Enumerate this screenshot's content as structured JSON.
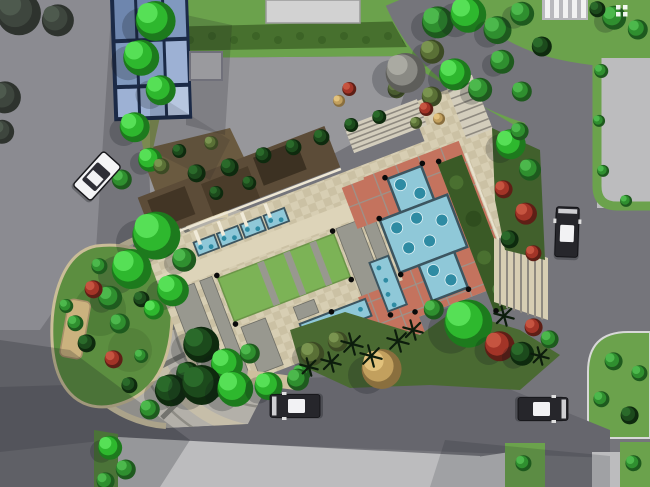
{
  "meta": {
    "width": 650,
    "height": 487,
    "view": "site-plan-top-down"
  },
  "palette": {
    "road": "#75757b",
    "roadLight": "#8b8b91",
    "roadBottom": "#66666d",
    "sidewalk": "#bcbcbe",
    "padTop": "#d2d2d2",
    "forecourt": "#97979b",
    "lawn": "#6ba24c",
    "lawnBright": "#7cb356",
    "lawnDark": "#55803a",
    "hedgeRow": "#47702e",
    "median": "#7b8a50",
    "plazaBeigeA": "#d7ceb3",
    "plazaBeigeB": "#cbc1a4",
    "walkBeige": "#ddd4b9",
    "walkGray": "#98988f",
    "walkGrayEdge": "#6e6e66",
    "redPaving": "#c4735e",
    "redLine": "#9b938b",
    "poolBlue": "#8fc8d8",
    "poolDeep": "#2e8ba3",
    "poolEdge": "#3c5560",
    "hedgeGreen": "#3a5a26",
    "terraceBrown": "#5c4c38",
    "terraceDark": "#423525",
    "gardenBed": "#6a5a40",
    "glassDark": "#6e86ae",
    "glassMid": "#8099bf",
    "glassLight": "#9db1d4",
    "glassFrame": "#1b2a47",
    "fanPaving": "#b3b0a9",
    "fanSpoke": "#73736e",
    "fanArc": "#8e8c85",
    "rimBeige": "#d6cbaa",
    "island": "#5c8e40",
    "islandEdge": "#cabd98",
    "benchTan": "#cbb27e",
    "plantBedSE": "#4a6a32",
    "plantBandE": "#41602c",
    "stepLight": "#d3cdbc",
    "stepLine": "#8f8a80",
    "carDark": "#26262b",
    "carLight": "#f4f4f6",
    "carGlass": "#2e2e36",
    "carRoof": "#f2f2f4",
    "crosswalkPad": "#b9b9bd",
    "crosswalkBar": "#f2f2f2",
    "shadow": "#14161c",
    "white": "#ffffff",
    "black": "#0a0a0a"
  },
  "tree_palettes": {
    "bright": [
      "#1d7a1d",
      "#2eb82e",
      "#56e056"
    ],
    "mid": [
      "#1e5a1e",
      "#2f8f2f",
      "#4cb84c"
    ],
    "dark": [
      "#0e2a0e",
      "#1c4a1c",
      "#2a6a2a"
    ],
    "olive": [
      "#3c4a24",
      "#5a7036",
      "#7a9450"
    ],
    "red": [
      "#5e1f16",
      "#a23427",
      "#c65440"
    ],
    "gray": [
      "#5e5e5a",
      "#8a8a84",
      "#aaaaa2"
    ],
    "tan": [
      "#8a6f3e",
      "#c2a05e",
      "#e2c27c"
    ],
    "sil": [
      "#2e332e",
      "#3e463e",
      "#4e5a4e"
    ]
  },
  "trees": [
    [
      152,
      18,
      20,
      "bright"
    ],
    [
      138,
      55,
      18,
      "bright"
    ],
    [
      158,
      88,
      15,
      "bright"
    ],
    [
      132,
      125,
      15,
      "bright"
    ],
    [
      148,
      158,
      12,
      "bright"
    ],
    [
      120,
      178,
      10,
      "mid"
    ],
    [
      15,
      10,
      22,
      "sil"
    ],
    [
      55,
      18,
      16,
      "sil"
    ],
    [
      2,
      95,
      16,
      "sil"
    ],
    [
      0,
      130,
      12,
      "sil"
    ],
    [
      435,
      20,
      16,
      "mid"
    ],
    [
      465,
      12,
      18,
      "bright"
    ],
    [
      495,
      28,
      14,
      "mid"
    ],
    [
      520,
      12,
      12,
      "mid"
    ],
    [
      540,
      45,
      10,
      "dark"
    ],
    [
      430,
      50,
      12,
      "olive"
    ],
    [
      452,
      72,
      16,
      "bright"
    ],
    [
      478,
      88,
      12,
      "mid"
    ],
    [
      430,
      95,
      10,
      "olive"
    ],
    [
      500,
      60,
      12,
      "mid"
    ],
    [
      520,
      90,
      10,
      "mid"
    ],
    [
      395,
      88,
      9,
      "olive"
    ],
    [
      402,
      70,
      20,
      "gray"
    ],
    [
      425,
      108,
      7,
      "red"
    ],
    [
      438,
      118,
      6,
      "tan"
    ],
    [
      415,
      122,
      6,
      "olive"
    ],
    [
      348,
      88,
      7,
      "red"
    ],
    [
      338,
      100,
      6,
      "tan"
    ],
    [
      612,
      16,
      12,
      "mid"
    ],
    [
      636,
      28,
      10,
      "mid"
    ],
    [
      596,
      8,
      8,
      "dark"
    ],
    [
      152,
      232,
      24,
      "bright"
    ],
    [
      128,
      266,
      20,
      "bright"
    ],
    [
      170,
      288,
      16,
      "bright"
    ],
    [
      108,
      296,
      12,
      "mid"
    ],
    [
      182,
      258,
      12,
      "mid"
    ],
    [
      195,
      172,
      9,
      "dark"
    ],
    [
      228,
      166,
      9,
      "dark"
    ],
    [
      262,
      154,
      8,
      "dark"
    ],
    [
      292,
      146,
      8,
      "dark"
    ],
    [
      215,
      192,
      7,
      "dark"
    ],
    [
      248,
      182,
      7,
      "dark"
    ],
    [
      320,
      136,
      8,
      "dark"
    ],
    [
      350,
      124,
      7,
      "dark"
    ],
    [
      378,
      116,
      7,
      "dark"
    ],
    [
      160,
      165,
      8,
      "olive"
    ],
    [
      178,
      150,
      7,
      "dark"
    ],
    [
      210,
      142,
      7,
      "olive"
    ],
    [
      198,
      342,
      18,
      "dark"
    ],
    [
      224,
      362,
      16,
      "bright"
    ],
    [
      186,
      372,
      12,
      "dark"
    ],
    [
      248,
      352,
      10,
      "mid"
    ],
    [
      210,
      385,
      12,
      "bright"
    ],
    [
      92,
      288,
      9,
      "red"
    ],
    [
      118,
      322,
      10,
      "mid"
    ],
    [
      85,
      342,
      9,
      "dark"
    ],
    [
      112,
      358,
      9,
      "red"
    ],
    [
      140,
      298,
      8,
      "dark"
    ],
    [
      74,
      322,
      8,
      "mid"
    ],
    [
      128,
      384,
      8,
      "dark"
    ],
    [
      152,
      308,
      10,
      "bright"
    ],
    [
      98,
      265,
      8,
      "mid"
    ],
    [
      65,
      305,
      7,
      "mid"
    ],
    [
      140,
      355,
      7,
      "mid"
    ],
    [
      508,
      142,
      15,
      "bright"
    ],
    [
      528,
      168,
      11,
      "mid"
    ],
    [
      502,
      188,
      9,
      "red"
    ],
    [
      524,
      212,
      11,
      "red"
    ],
    [
      508,
      238,
      9,
      "dark"
    ],
    [
      532,
      252,
      8,
      "red"
    ],
    [
      518,
      130,
      9,
      "mid"
    ],
    [
      378,
      366,
      20,
      "tan"
    ],
    [
      464,
      320,
      24,
      "bright"
    ],
    [
      497,
      344,
      15,
      "red"
    ],
    [
      532,
      326,
      9,
      "red"
    ],
    [
      520,
      352,
      12,
      "dark"
    ],
    [
      548,
      338,
      9,
      "mid"
    ],
    [
      310,
      352,
      12,
      "olive"
    ],
    [
      336,
      340,
      10,
      "olive"
    ],
    [
      432,
      308,
      10,
      "mid"
    ],
    [
      300,
      372,
      9,
      "mid"
    ],
    [
      168,
      388,
      16,
      "dark"
    ],
    [
      198,
      382,
      20,
      "dark"
    ],
    [
      232,
      386,
      18,
      "bright"
    ],
    [
      266,
      384,
      14,
      "bright"
    ],
    [
      296,
      378,
      11,
      "mid"
    ],
    [
      148,
      408,
      10,
      "mid"
    ],
    [
      108,
      446,
      12,
      "bright"
    ],
    [
      124,
      468,
      10,
      "mid"
    ],
    [
      104,
      480,
      9,
      "mid"
    ],
    [
      612,
      360,
      9,
      "mid"
    ],
    [
      600,
      398,
      8,
      "mid"
    ],
    [
      628,
      414,
      9,
      "dark"
    ],
    [
      638,
      372,
      8,
      "mid"
    ],
    [
      600,
      70,
      7,
      "mid"
    ],
    [
      598,
      120,
      6,
      "mid"
    ],
    [
      602,
      170,
      6,
      "mid"
    ],
    [
      625,
      200,
      6,
      "mid"
    ],
    [
      522,
      462,
      8,
      "mid"
    ],
    [
      632,
      462,
      8,
      "mid"
    ]
  ],
  "palms": [
    [
      352,
      344,
      11
    ],
    [
      371,
      356,
      11
    ],
    [
      331,
      362,
      10
    ],
    [
      398,
      341,
      11
    ],
    [
      309,
      367,
      9
    ],
    [
      413,
      330,
      10
    ],
    [
      504,
      316,
      10
    ],
    [
      540,
      356,
      9
    ]
  ],
  "hedge_dots": [
    [
      168,
      36
    ],
    [
      190,
      40
    ],
    [
      212,
      36
    ],
    [
      234,
      40
    ],
    [
      256,
      36
    ],
    [
      278,
      40
    ],
    [
      300,
      36
    ],
    [
      322,
      40
    ],
    [
      344,
      36
    ],
    [
      366,
      40
    ],
    [
      388,
      36
    ],
    [
      406,
      40
    ]
  ],
  "plaza": {
    "pool_dots": [
      [
        262,
        22
      ],
      [
        277,
        37
      ],
      [
        243,
        61
      ],
      [
        265,
        59
      ],
      [
        247,
        84
      ],
      [
        269,
        85
      ],
      [
        288,
        70
      ],
      [
        262,
        114
      ],
      [
        275,
        129
      ]
    ],
    "pool_dots_small": [
      [
        53,
        9
      ],
      [
        63,
        12
      ],
      [
        78,
        9
      ],
      [
        88,
        12
      ],
      [
        103,
        9
      ],
      [
        113,
        12
      ],
      [
        128,
        9
      ],
      [
        138,
        12
      ],
      [
        126,
        124
      ],
      [
        140,
        128
      ],
      [
        154,
        123
      ],
      [
        168,
        127
      ],
      [
        180,
        124
      ],
      [
        212,
        92
      ],
      [
        214,
        106
      ],
      [
        211,
        120
      ],
      [
        213,
        132
      ]
    ],
    "bollards": [
      [
        58,
        41
      ],
      [
        182,
        41
      ],
      [
        58,
        93
      ],
      [
        182,
        93
      ],
      [
        230,
        46
      ],
      [
        230,
        106
      ],
      [
        250,
        10
      ],
      [
        290,
        10
      ],
      [
        252,
        144
      ],
      [
        288,
        144
      ],
      [
        206,
        140
      ],
      [
        152,
        116
      ],
      [
        306,
        14
      ],
      [
        306,
        174
      ],
      [
        230,
        146
      ]
    ]
  },
  "cars": [
    {
      "x": 97,
      "y": 176,
      "angle": 42,
      "kind": "light"
    },
    {
      "x": 567,
      "y": 232,
      "angle": 2,
      "kind": "dark"
    },
    {
      "x": 295,
      "y": 406,
      "angle": -90,
      "kind": "dark"
    },
    {
      "x": 543,
      "y": 409,
      "angle": 90,
      "kind": "dark"
    }
  ],
  "icon": {
    "name": "building-grid-icon",
    "color": "#ffffff",
    "cells": [
      [
        616,
        5
      ],
      [
        623,
        5
      ],
      [
        616,
        12
      ],
      [
        623,
        12
      ]
    ]
  }
}
